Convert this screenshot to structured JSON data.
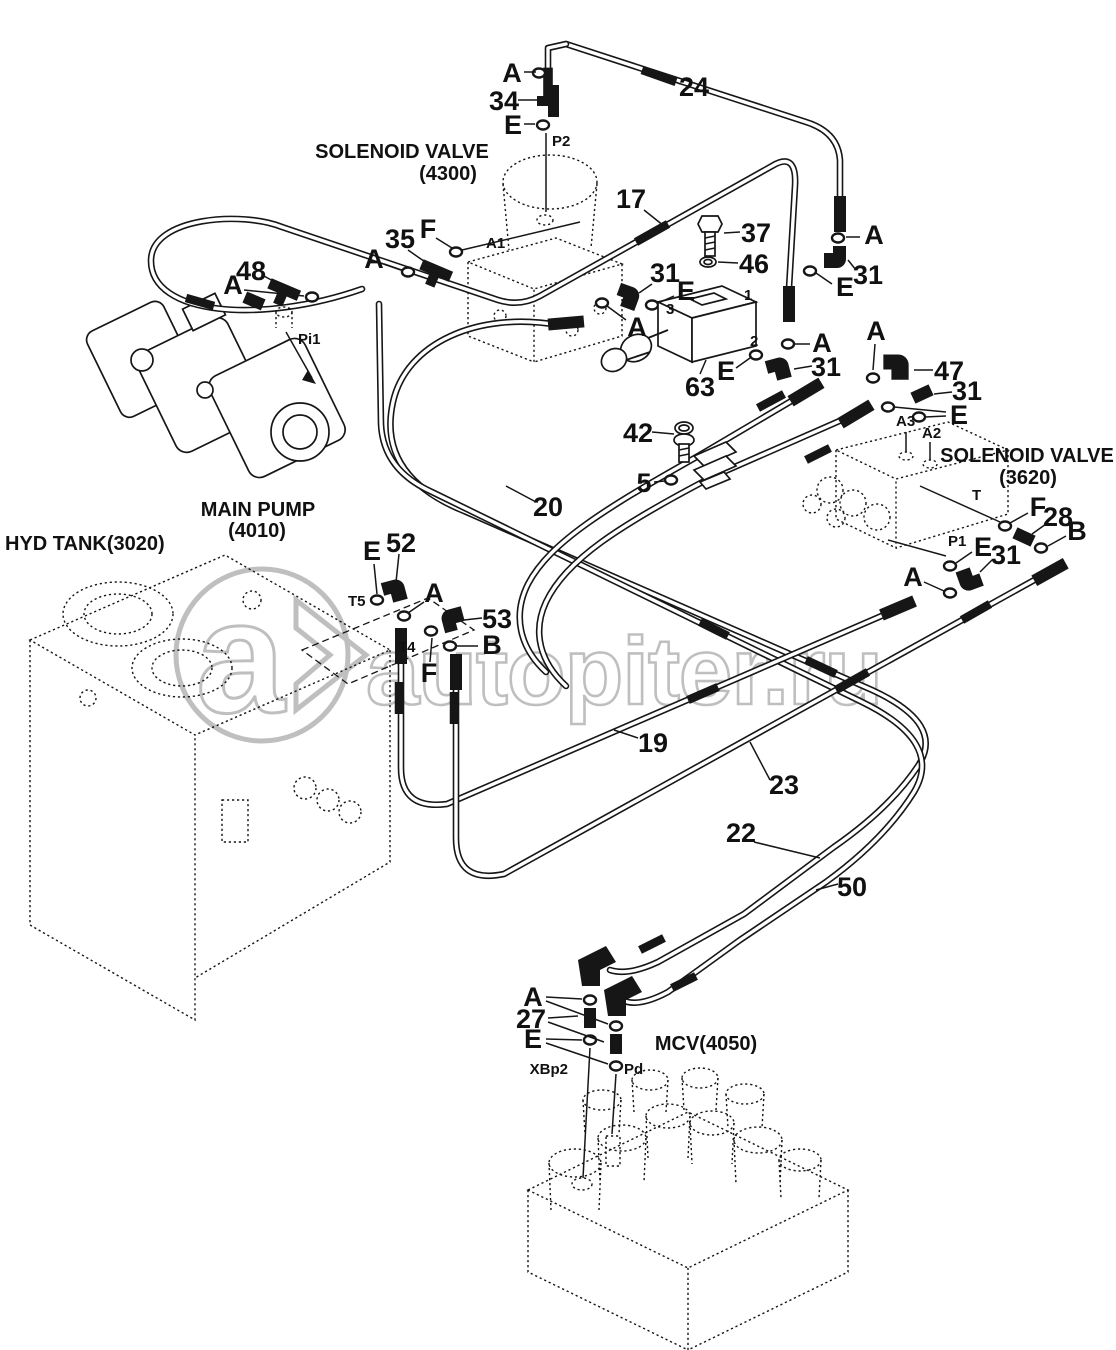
{
  "watermark": {
    "text": "autopiter.ru",
    "logo_letter": "a",
    "color": "#bfbfbf"
  },
  "components": {
    "sv4300_line1": "SOLENOID VALVE",
    "sv4300_line2": "(4300)",
    "sv3620_line1": "SOLENOID VALVE",
    "sv3620_line2": "(3620)",
    "pump_line1": "MAIN PUMP",
    "pump_line2": "(4010)",
    "tank": "HYD TANK(3020)",
    "mcv": "MCV(4050)"
  },
  "callouts": {
    "c5": "5",
    "c17": "17",
    "c19": "19",
    "c20": "20",
    "c22": "22",
    "c23": "23",
    "c24": "24",
    "c27": "27",
    "c28": "28",
    "c31": "31",
    "c34": "34",
    "c35": "35",
    "c37": "37",
    "c42": "42",
    "c46": "46",
    "c47": "47",
    "c48": "48",
    "c50": "50",
    "c52": "52",
    "c53": "53",
    "c63": "63"
  },
  "letters": {
    "A": "A",
    "B": "B",
    "E": "E",
    "F": "F"
  },
  "ports": {
    "p2": "P2",
    "a1": "A1",
    "pi1": "Pi1",
    "t5": "T5",
    "t4": "T4",
    "t": "T",
    "p1": "P1",
    "a2": "A2",
    "a3": "A3",
    "xbp2": "XBp2",
    "pd": "Pd",
    "n1": "1",
    "n2": "2",
    "n3": "3"
  }
}
